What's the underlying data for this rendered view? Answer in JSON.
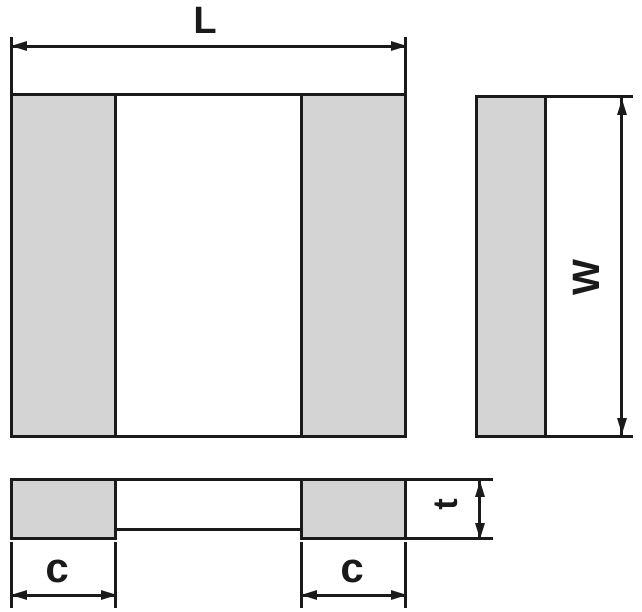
{
  "labels": {
    "length": "L",
    "width": "W",
    "electrode_left": "c",
    "electrode_right": "c",
    "thickness": "t"
  },
  "colors": {
    "terminal_fill": "#d4d4d4",
    "line": "#1a1a1a",
    "background": "#ffffff"
  },
  "icons": {
    "dimension_arrowhead": "filled-triangle (css border shape)"
  }
}
